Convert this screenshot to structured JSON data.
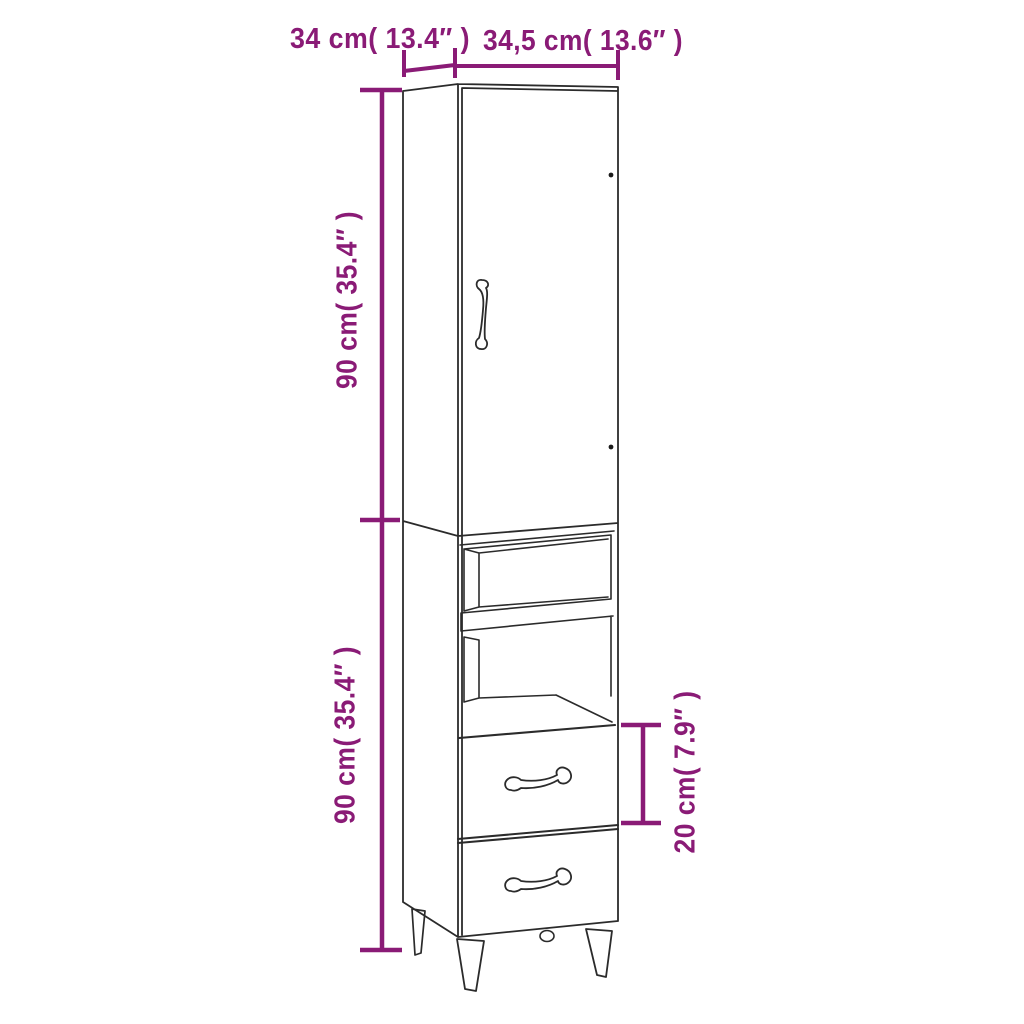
{
  "diagram": {
    "accent_color": "#8A1B76",
    "line_color": "#2B2B2B",
    "background_color": "#FFFFFF",
    "labels": {
      "depth": "34 cm( 13.4″ )",
      "width": "34,5 cm( 13.6″ )",
      "height_upper": "90 cm( 35.4″ )",
      "height_lower": "90 cm( 35.4″ )",
      "drawer": "20 cm( 7.9″ )"
    },
    "values": {
      "depth_cm": 34,
      "depth_in": 13.4,
      "width_cm": 34.5,
      "width_in": 13.6,
      "height_upper_cm": 90,
      "height_upper_in": 35.4,
      "height_lower_cm": 90,
      "height_lower_in": 35.4,
      "drawer_cm": 20,
      "drawer_in": 7.9
    }
  }
}
